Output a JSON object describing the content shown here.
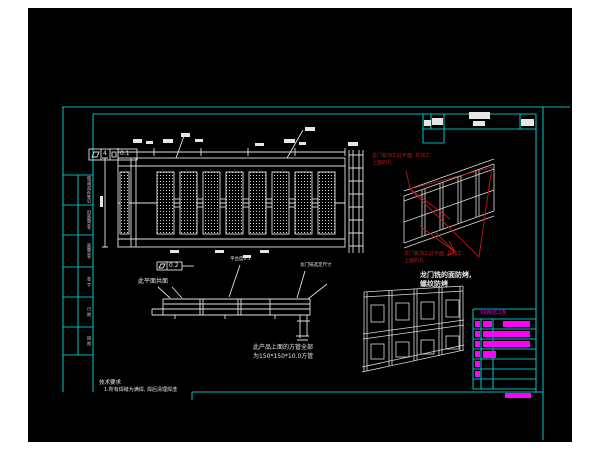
{
  "meta": {
    "description": "CAD engineering drawing of a welded gantry platform frame, black model-space background with cyan sheet border",
    "colors": {
      "page_bg": "#ffffff",
      "canvas_bg": "#000000",
      "border_cyan": "#00b6b6",
      "line_white": "#e6e6e6",
      "annotation_red": "#c41414",
      "table_magenta": "#ff00ff"
    }
  },
  "texts": {
    "red_note_top_l1": "龙门铣加工此平面, 并加工",
    "red_note_top_l2": "上面的孔",
    "red_note_bottom_l1": "龙门铣加工此平面, 并加工",
    "red_note_bottom_l2": "上面的孔",
    "face_note_l1": "龙门铣的面防烤,",
    "face_note_l2": "螺纹防烤",
    "tube_note_l1": "此产品上面的方管全部",
    "tube_note_l2": "为150*150*10.0方管",
    "coplanar_note": "此平面共面",
    "platform_note": "平台度0.1",
    "gantry_note": "龙门铣选定尺寸",
    "tech_req_title": "技术要求",
    "tech_req_line": "1.所有焊缝为满焊, 焊后清理焊渣"
  },
  "fcf_top": {
    "prefix": "4",
    "value": "0.1"
  },
  "fcf_mid": {
    "value": "0.2"
  },
  "process_table": {
    "header": "下料制造工序"
  },
  "left_strip": {
    "cells": [
      {
        "label": "借(通)用件登记"
      },
      {
        "label": "旧底图总号"
      },
      {
        "label": "底图总号"
      },
      {
        "label": "签 字"
      },
      {
        "label": "日 期"
      },
      {
        "label": "描 图"
      }
    ]
  },
  "blocks": {
    "white": [
      [
        469,
        112,
        21,
        7
      ],
      [
        473,
        121,
        12,
        5
      ],
      [
        432,
        118,
        11,
        7
      ],
      [
        424,
        120,
        7,
        6
      ],
      [
        521,
        119,
        13,
        7
      ],
      [
        133,
        139,
        9,
        4
      ],
      [
        146,
        141,
        7,
        3
      ],
      [
        163,
        139,
        10,
        4
      ],
      [
        181,
        133,
        9,
        4
      ],
      [
        195,
        139,
        8,
        3
      ],
      [
        284,
        139,
        11,
        4
      ],
      [
        299,
        142,
        7,
        3
      ],
      [
        305,
        127,
        10,
        4
      ],
      [
        255,
        143,
        9,
        3
      ],
      [
        348,
        142,
        10,
        4
      ],
      [
        170,
        250,
        9,
        3
      ],
      [
        215,
        250,
        9,
        3
      ],
      [
        260,
        250,
        9,
        3
      ],
      [
        243,
        255,
        8,
        3
      ],
      [
        100,
        196,
        3,
        11
      ]
    ],
    "magenta": [
      [
        475,
        321,
        5,
        6
      ],
      [
        475,
        331,
        5,
        6
      ],
      [
        475,
        341,
        5,
        6
      ],
      [
        475,
        351,
        5,
        6
      ],
      [
        475,
        361,
        5,
        6
      ],
      [
        475,
        371,
        5,
        6
      ],
      [
        483,
        321,
        9,
        6
      ],
      [
        503,
        321,
        27,
        6
      ],
      [
        483,
        331,
        47,
        6
      ],
      [
        483,
        341,
        47,
        6
      ],
      [
        483,
        351,
        13,
        7
      ],
      [
        505,
        393,
        26,
        5
      ]
    ]
  }
}
